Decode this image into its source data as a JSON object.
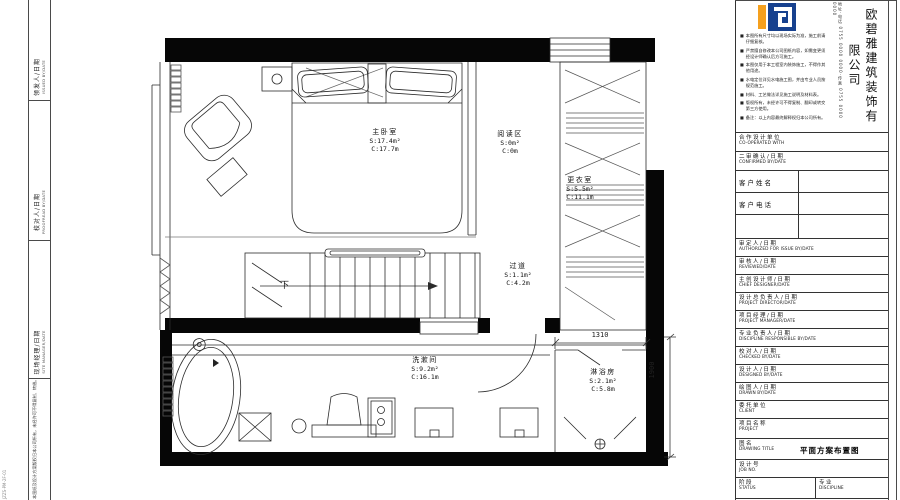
{
  "sheet": {
    "left_margin": {
      "labels": [
        {
          "cn": "领发人/日期",
          "en": "ISSUED BY/DATE"
        },
        {
          "cn": "校对人/日期",
          "en": "PROOFREAD BY/DATE"
        },
        {
          "cn": "现场经理/日期",
          "en": "SITE MANAGER/DATE"
        }
      ],
      "bottom_note": "本图纸及设计方案版权归本公司所有，未经许可不得复制、转借。",
      "edge_code": "JZZS-PM-2F-01"
    }
  },
  "plan": {
    "rooms": {
      "master": {
        "name": "主卧室",
        "area": "S:17.4m²",
        "perimeter": "C:17.7m"
      },
      "reading": {
        "name": "阅读区",
        "area": "S:0m²",
        "perimeter": "C:0m"
      },
      "dressing": {
        "name": "更衣室",
        "area": "S:5.5m²",
        "perimeter": "C:11.1m"
      },
      "corridor": {
        "name": "过道",
        "area": "S:1.1m²",
        "perimeter": "C:4.2m"
      },
      "washroom": {
        "name": "洗漱间",
        "area": "S:9.2m²",
        "perimeter": "C:16.1m"
      },
      "shower": {
        "name": "淋浴房",
        "area": "S:2.1m²",
        "perimeter": "C:5.8m"
      }
    },
    "stairs_label": "下",
    "dims": {
      "shower_width": "1310",
      "shower_depth": "1900"
    }
  },
  "titleblock": {
    "company": {
      "name": "欧碧雅建筑装饰有限公司",
      "contact": "地址·电话 0755 0000 0000·传真 0755 0000 0000",
      "logo_blue": "#17418e",
      "logo_orange": "#f5a01e"
    },
    "bullet": "■",
    "notes": [
      "本图所有尺寸均以现场实际为准，施工前请仔细复核。",
      "严禁擅自修改本公司图纸内容，如需变更须经设计师确认后方可施工。",
      "本图仅用于本工程室内装饰施工，不得作其他用途。",
      "水电定位详见水电施工图，并由专业人员按规范施工。",
      "材料、工艺做法详见施工说明及材料表。",
      "版权所有，未经许可不得复制、翻印或转交第三方使用。",
      "备注：以上内容最终解释权归本公司所有。"
    ],
    "rows": [
      {
        "cn": "合作设计单位",
        "en": "CO-OPERATED WITH"
      },
      {
        "cn": "二审确认/日期",
        "en": "CONFIRMED BY/DATE"
      },
      {
        "cn": "客户姓名",
        "en": ""
      },
      {
        "cn": "客户电话",
        "en": ""
      },
      {
        "cn": "",
        "en": ""
      },
      {
        "cn": "审定人/日期",
        "en": "AUTHORIZED FOR ISSUE BY/DATE"
      },
      {
        "cn": "审核人/日期",
        "en": "REVIEWED/DATE"
      },
      {
        "cn": "主创设计师/日期",
        "en": "CHIEF DESIGNER/DATE"
      },
      {
        "cn": "设计总负责人/日期",
        "en": "PROJECT DIRECTOR/DATE"
      },
      {
        "cn": "项目经理/日期",
        "en": "PROJECT MANAGER/DATE"
      },
      {
        "cn": "专业负责人/日期",
        "en": "DISCIPLINE RESPONSIBLE BY/DATE"
      },
      {
        "cn": "校对人/日期",
        "en": "CHECKED BY/DATE"
      },
      {
        "cn": "设计人/日期",
        "en": "DESIGNED BY/DATE"
      },
      {
        "cn": "绘图人/日期",
        "en": "DRAWN BY/DATE"
      },
      {
        "cn": "委托单位",
        "en": "CLIENT"
      },
      {
        "cn": "项目名称",
        "en": "PROJECT"
      },
      {
        "cn": "图名",
        "en": "DRAWING TITLE",
        "value": "平面方案布置图"
      },
      {
        "cn": "设计号",
        "en": "JOB NO."
      },
      {
        "cn": "阶段",
        "en": "STATUS",
        "cn2": "专业",
        "en2": "DISCIPLINE"
      }
    ]
  }
}
